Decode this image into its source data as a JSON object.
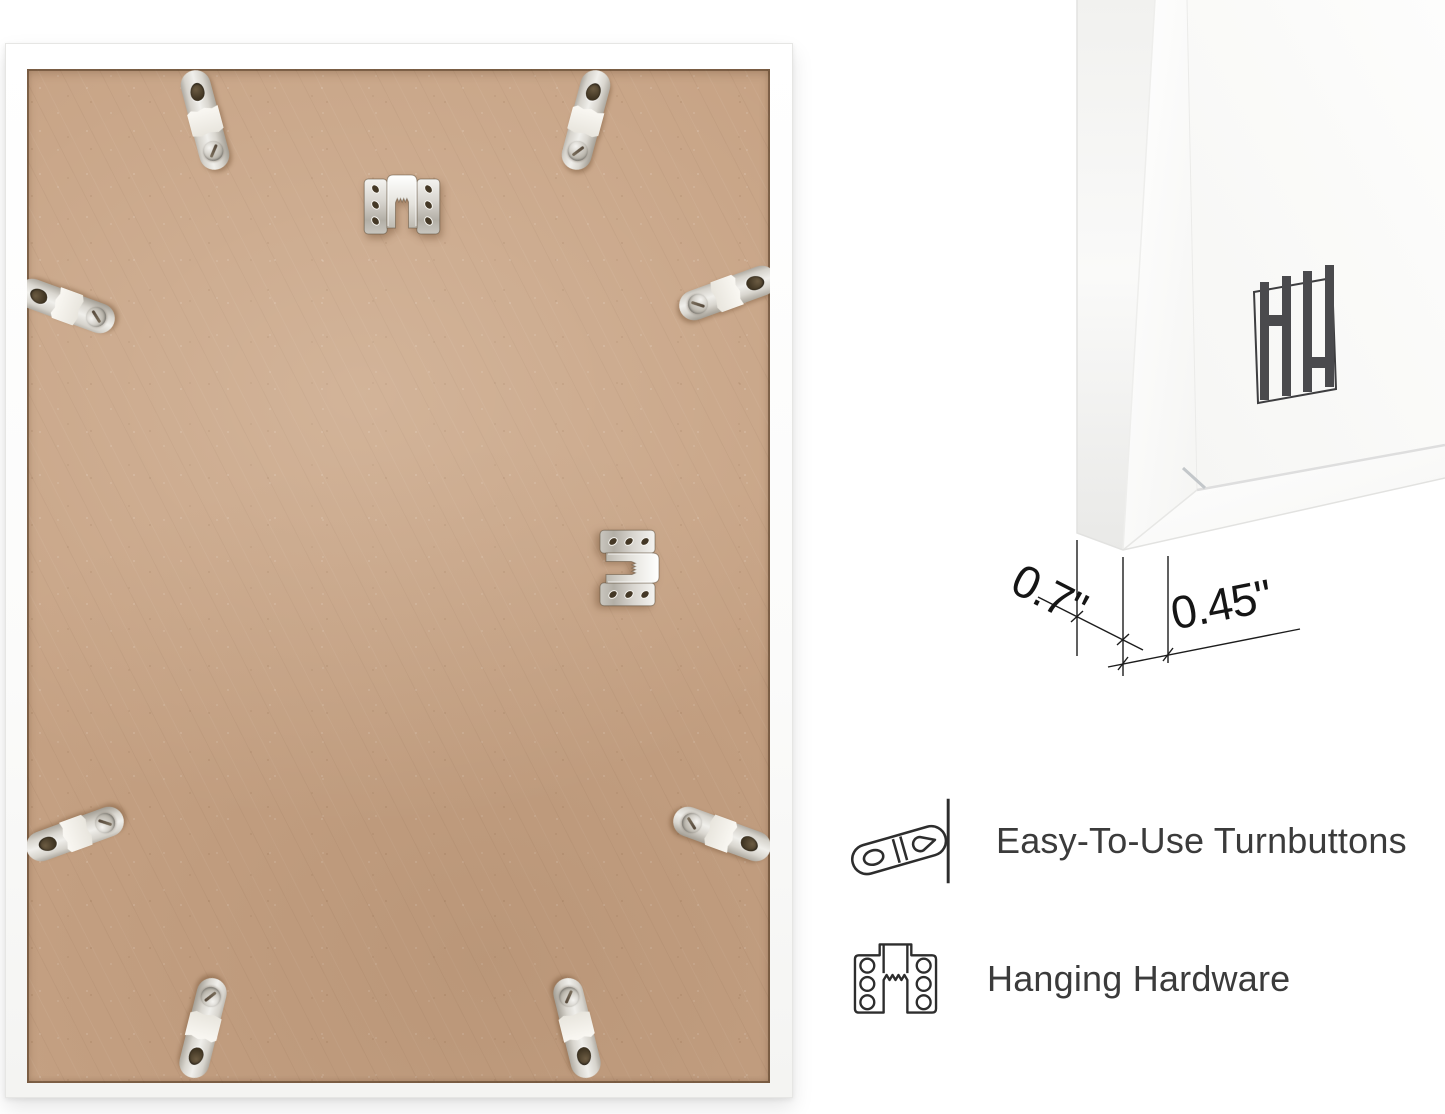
{
  "corner_detail": {
    "depth_label": "0.7\"",
    "face_width_label": "0.45\"",
    "logo_icon": "hh-logo"
  },
  "features": [
    {
      "icon": "turnbutton-icon",
      "label": "Easy-To-Use Turnbuttons"
    },
    {
      "icon": "hanging-hardware-icon",
      "label": "Hanging Hardware"
    }
  ],
  "back_photo": {
    "turnbutton_count": 8,
    "sawtooth_hanger_count": 2,
    "board_color": "#c7a385",
    "frame_color": "#ffffff",
    "metal_color": "#d8d5cf"
  },
  "text_color": "#3b3b3b",
  "line_color": "#1c1c1c"
}
